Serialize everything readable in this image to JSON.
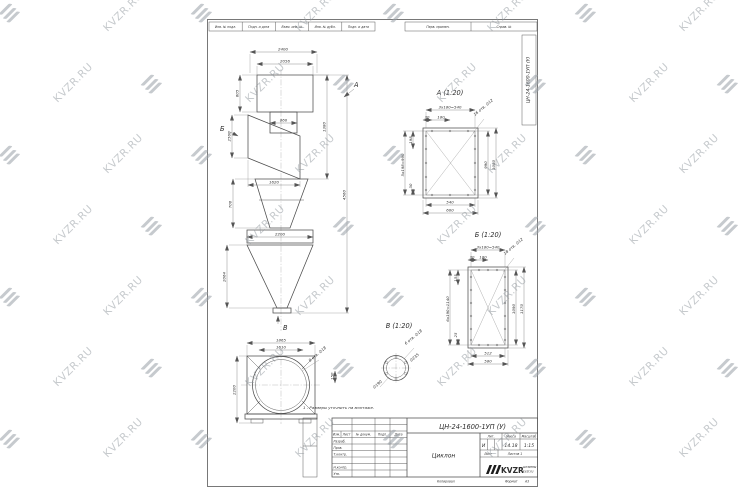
{
  "watermark": {
    "text": "KVZR.RU"
  },
  "top_strip": {
    "c1": "Инв. № подл.",
    "c2": "Подп. и дата",
    "c3": "Взам. инв. №",
    "c4": "Инв. № дубл.",
    "c5": "Подп. и дата",
    "c6": "Перв. примен.",
    "c7": "Справ. №"
  },
  "side_label": "ЦН-24-1600-1УП (У)",
  "note": "1 - Размеры уточнить на монтаже.",
  "front_view": {
    "arrow_a": "А",
    "arrow_b": "Б",
    "arrow_v": "В",
    "dims": {
      "d1": "2400",
      "d2": "2056",
      "d3": "605",
      "d4": "1380",
      "d5": "860",
      "d6": "2560",
      "d7": "1620",
      "d8": "700",
      "d9": "2200",
      "d10": "2064",
      "d11": "4560"
    }
  },
  "bottom_view": {
    "dims": {
      "d1": "1610",
      "d2": "1865",
      "d3": "2200",
      "d4": "150",
      "holes": "8 отв. ∅18"
    }
  },
  "view_a": {
    "title": "А (1:20)",
    "dims": {
      "top": "3х180=540",
      "t30": "30",
      "t180": "180",
      "holes": "16 отв. ∅12",
      "right_in": "990",
      "right_out": "1080",
      "left": "5х198=990",
      "l198": "198",
      "l30": "30",
      "bot_in": "540",
      "bot_out": "600"
    }
  },
  "view_b": {
    "title": "Б (1:20)",
    "dims": {
      "top": "3х180=540",
      "t30": "30",
      "t180": "180",
      "holes": "18 отв. ∅12",
      "right_in": "1090",
      "right_out": "1170",
      "left": "6х190=1140",
      "l155": "155",
      "l25": "25",
      "bot_in": "512",
      "bot_out": "580"
    }
  },
  "view_v": {
    "title": "В (1:20)",
    "holes": "6 отв. ∅18",
    "d1": "∅235",
    "d2": "∅190"
  },
  "title_block": {
    "doc_number": "ЦН-24-1600-1УП (У)",
    "name": "Циклон",
    "header": {
      "izm": "Изм.",
      "list": "Лист",
      "doc": "№ докум.",
      "podp": "Подп.",
      "data": "Дата"
    },
    "rows": {
      "r1": "Разраб.",
      "r2": "Пров.",
      "r3": "Т.контр.",
      "r4": "Н.контр.",
      "r5": "Утв."
    },
    "lit_label": "Лит.",
    "mass_label": "Масса",
    "scale_label": "Масштаб",
    "lit": "И",
    "mass": "14.18",
    "scale": "1:15",
    "sheet_label": "Лист",
    "sheets_label": "Листов 1",
    "logo": "KVZR",
    "logo_cap1": "штампы",
    "logo_cap2": "kvzr.ru",
    "copied": "Копировал",
    "format": "Формат",
    "format_val": "А3"
  }
}
